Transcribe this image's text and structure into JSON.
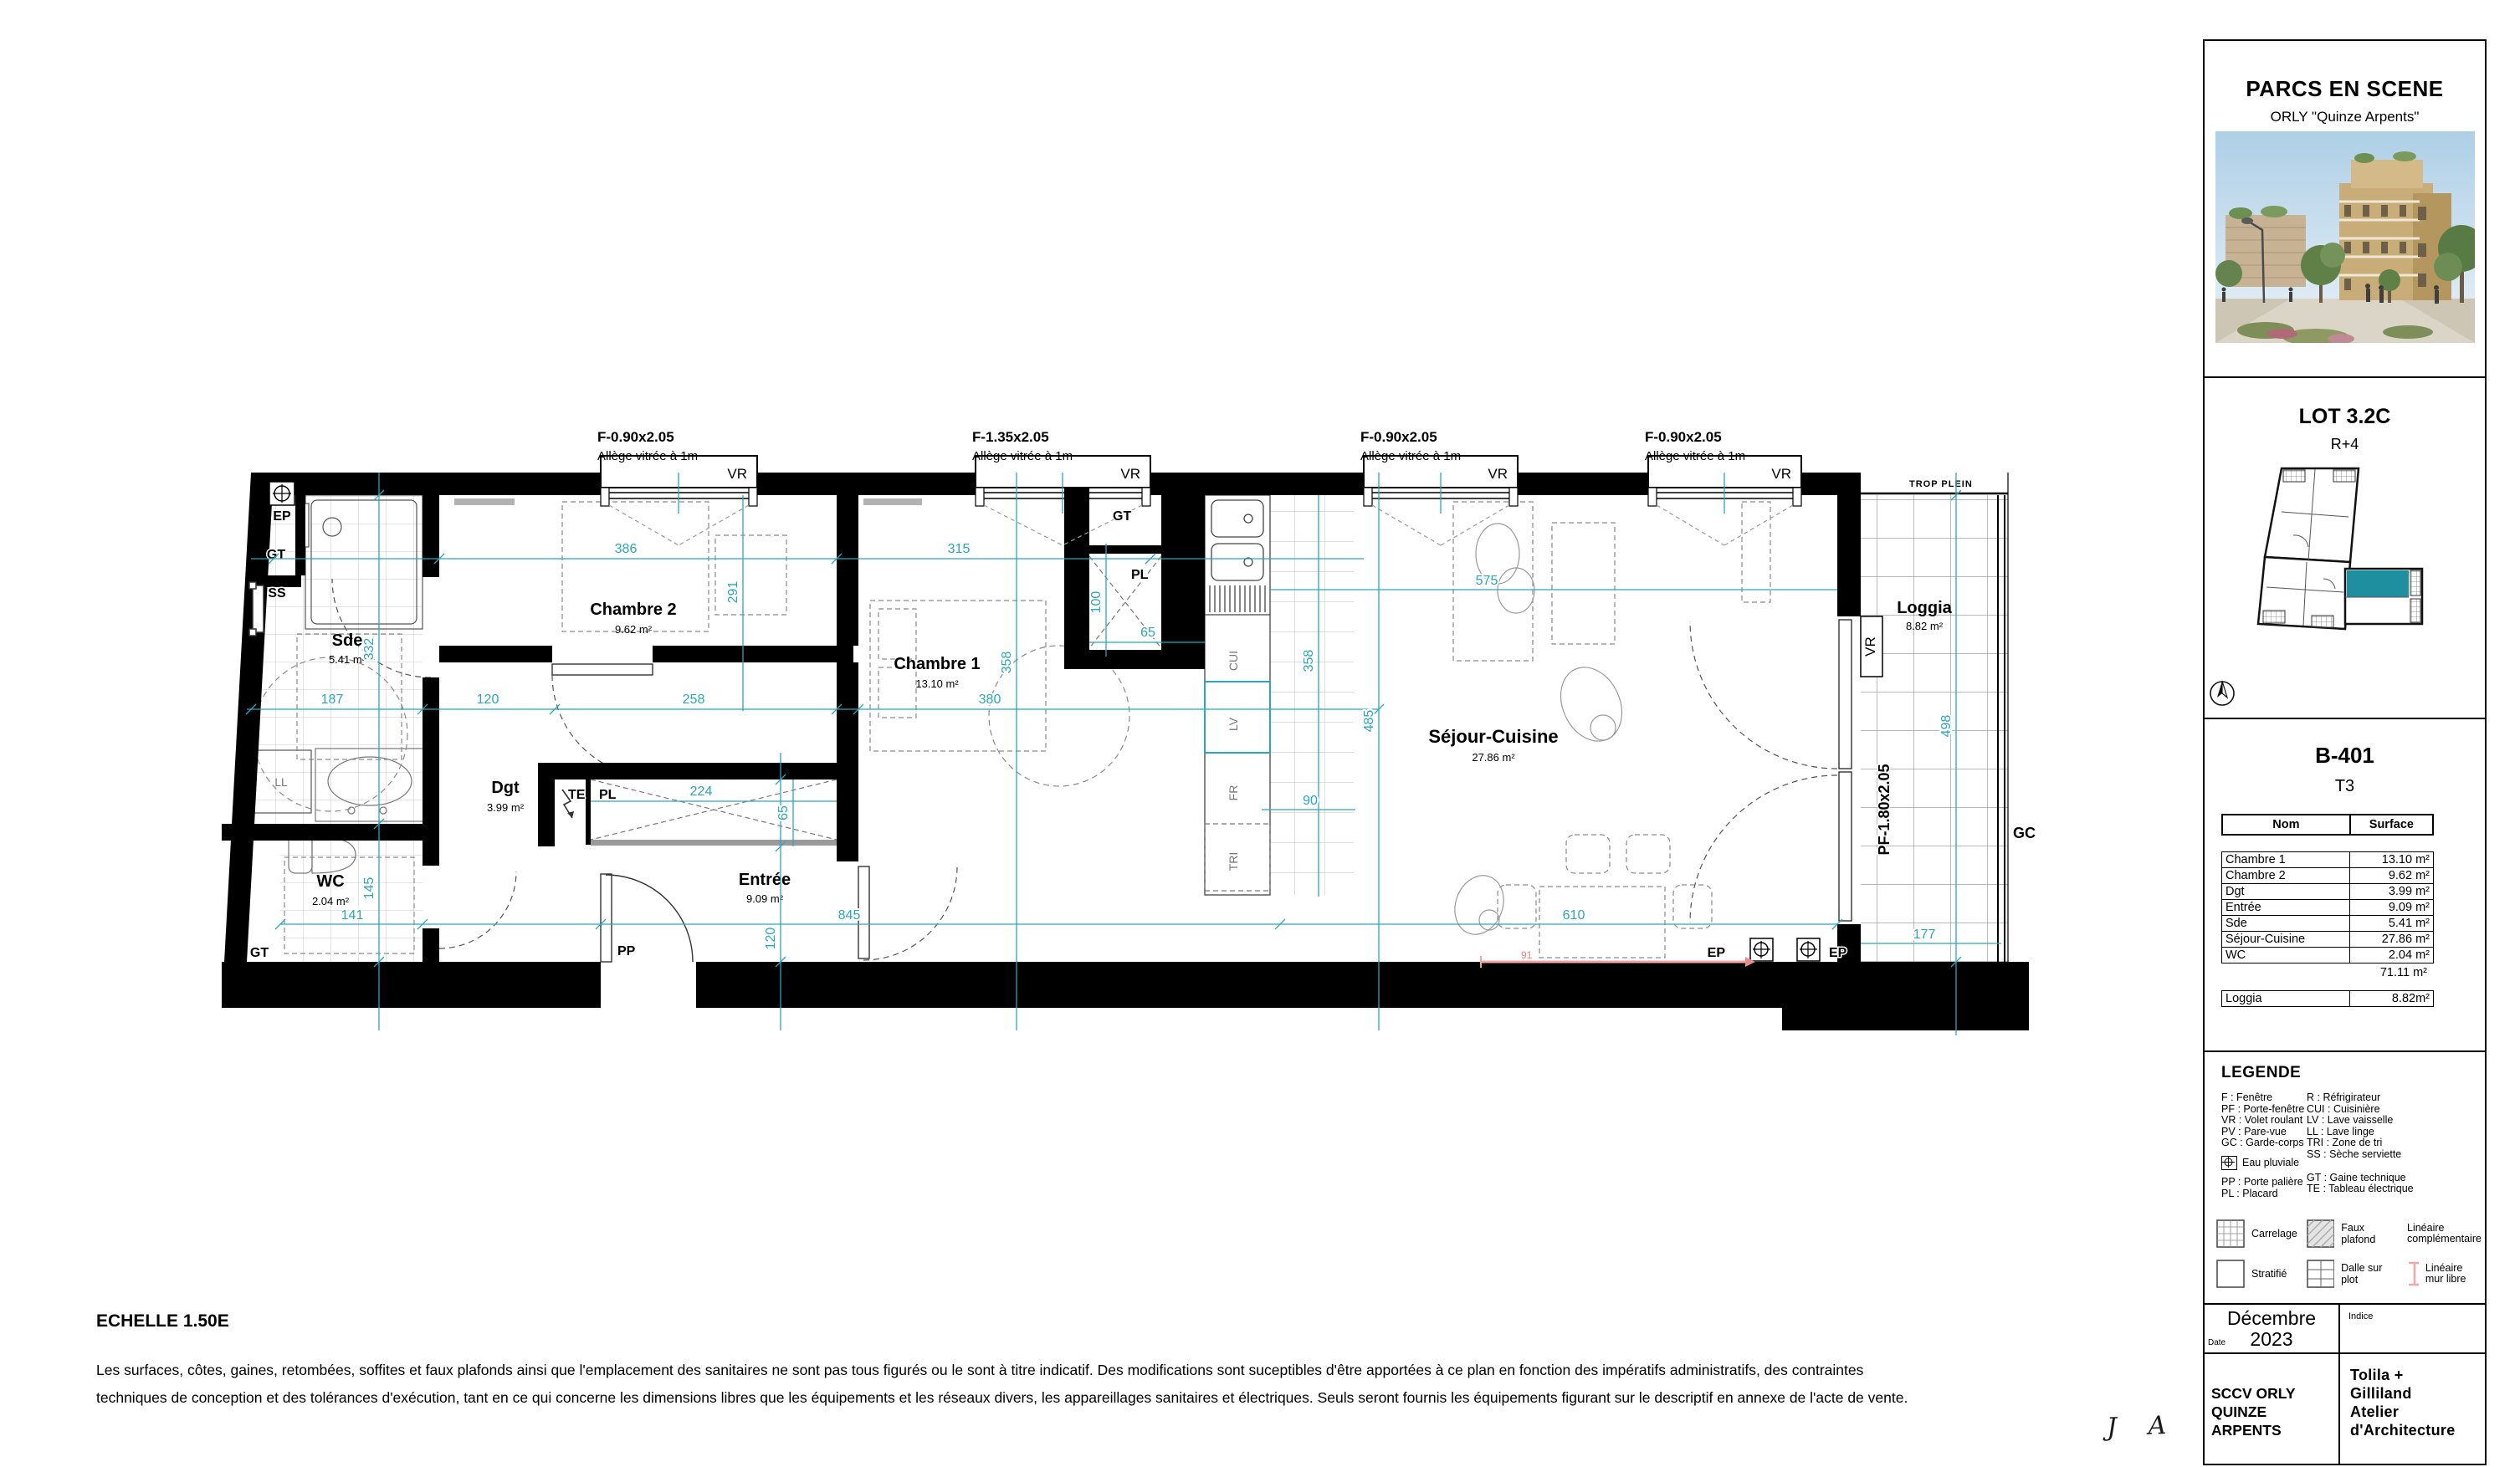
{
  "colors": {
    "dimension_teal": "#2AA7BC",
    "unit_highlight": "#1D8F9E",
    "free_wall_pink": "#F2A6A6"
  },
  "panel": {
    "project_title": "PARCS EN SCENE",
    "project_subtitle": "ORLY \"Quinze Arpents\"",
    "lot_title": "LOT 3.2C",
    "lot_level": "R+4",
    "unit_id": "B-401",
    "unit_type": "T3",
    "table": {
      "headers": {
        "name": "Nom",
        "surface": "Surface"
      },
      "rows": [
        {
          "name": "Chambre 1",
          "surface": "13.10 m²"
        },
        {
          "name": "Chambre 2",
          "surface": "9.62 m²"
        },
        {
          "name": "Dgt",
          "surface": "3.99 m²"
        },
        {
          "name": "Entrée",
          "surface": "9.09 m²"
        },
        {
          "name": "Sde",
          "surface": "5.41 m²"
        },
        {
          "name": "Séjour-Cuisine",
          "surface": "27.86 m²"
        },
        {
          "name": "WC",
          "surface": "2.04 m²"
        }
      ],
      "total": "71.11 m²",
      "loggia_row": {
        "name": "Loggia",
        "surface": "8.82m²"
      }
    },
    "legend": {
      "title": "LEGENDE",
      "left": [
        "F : Fenêtre",
        "PF : Porte-fenêtre",
        "VR : Volet roulant",
        "PV : Pare-vue",
        "GC : Garde-corps"
      ],
      "eau_pluviale": "Eau pluviale",
      "left2": [
        "PP : Porte palière",
        "PL : Placard"
      ],
      "right": [
        "R : Réfrigirateur",
        "CUI : Cuisinière",
        "LV : Lave vaisselle",
        "LL : Lave linge",
        "TRI : Zone de tri",
        "SS : Sèche serviette"
      ],
      "right2": [
        "GT : Gaine technique",
        "TE : Tableau électrique"
      ],
      "symbols": [
        {
          "label": "Carrelage"
        },
        {
          "label": "Faux plafond"
        },
        {
          "label": "Linéaire complémentaire"
        },
        {
          "label": "Stratifié"
        },
        {
          "label": "Dalle sur plot"
        },
        {
          "label": "Linéaire mur libre"
        }
      ]
    },
    "footer": {
      "date_label": "Date",
      "date_value_1": "Décembre",
      "date_value_2": "2023",
      "indice_label": "Indice",
      "client_1": "SCCV ORLY",
      "client_2": "QUINZE ARPENTS",
      "architect_1": "Tolila +",
      "architect_2": "Gilliland",
      "architect_3": "Atelier",
      "architect_4": "d'Architecture"
    }
  },
  "plan": {
    "window_labels": [
      {
        "size": "F-0.90x2.05",
        "sill": "Allège vitrée à 1m"
      },
      {
        "size": "F-1.35x2.05",
        "sill": "Allège vitrée à 1m"
      },
      {
        "size": "F-0.90x2.05",
        "sill": "Allège vitrée à 1m"
      },
      {
        "size": "F-0.90x2.05",
        "sill": "Allège vitrée à 1m"
      }
    ],
    "labels": {
      "vr": "VR",
      "pf": "PF-1.80x2.05",
      "trop_plein": "TROP PLEIN",
      "ep": "EP",
      "gt": "GT",
      "ss": "SS",
      "ll": "LL",
      "te": "TE",
      "pl": "PL",
      "pp": "PP",
      "cui": "CUI",
      "lv": "LV",
      "fr": "FR",
      "tri": "TRI",
      "gc": "GC"
    },
    "rooms": [
      {
        "name": "Chambre 2",
        "area": "9.62 m²"
      },
      {
        "name": "Chambre 1",
        "area": "13.10 m²"
      },
      {
        "name": "Sde",
        "area": "5.41 m²"
      },
      {
        "name": "Dgt",
        "area": "3.99 m²"
      },
      {
        "name": "WC",
        "area": "2.04 m²"
      },
      {
        "name": "Entrée",
        "area": "9.09 m²"
      },
      {
        "name": "Séjour-Cuisine",
        "area": "27.86 m²"
      },
      {
        "name": "Loggia",
        "area": "8.82 m²"
      }
    ],
    "dims": {
      "d386": "386",
      "d315": "315",
      "d291": "291",
      "d332": "332",
      "d187": "187",
      "d120": "120",
      "d258": "258",
      "d380": "380",
      "d358a": "358",
      "d358b": "358",
      "d100": "100",
      "d65a": "65",
      "d65b": "65",
      "d224": "224",
      "d845": "845",
      "d120v": "120",
      "d141": "141",
      "d145": "145",
      "d498": "498",
      "d177": "177",
      "d610": "610",
      "d90": "90",
      "d485": "485",
      "d575": "575",
      "d91": "91"
    }
  },
  "footer_note": {
    "scale": "ECHELLE 1.50E",
    "line1": "Les surfaces, côtes, gaines, retombées, soffites et faux plafonds ainsi que l'emplacement des sanitaires ne sont pas tous figurés ou le sont à titre indicatif. Des modifications sont suceptibles d'être apportées à ce plan en fonction des impératifs administratifs, des contraintes",
    "line2": "techniques de conception et des tolérances d'exécution, tant en ce qui concerne les dimensions libres que les équipements et les réseaux divers, les appareillages sanitaires et électriques. Seuls seront fournis les équipements figurant sur le descriptif en annexe de l'acte de vente."
  },
  "signature": "J A"
}
